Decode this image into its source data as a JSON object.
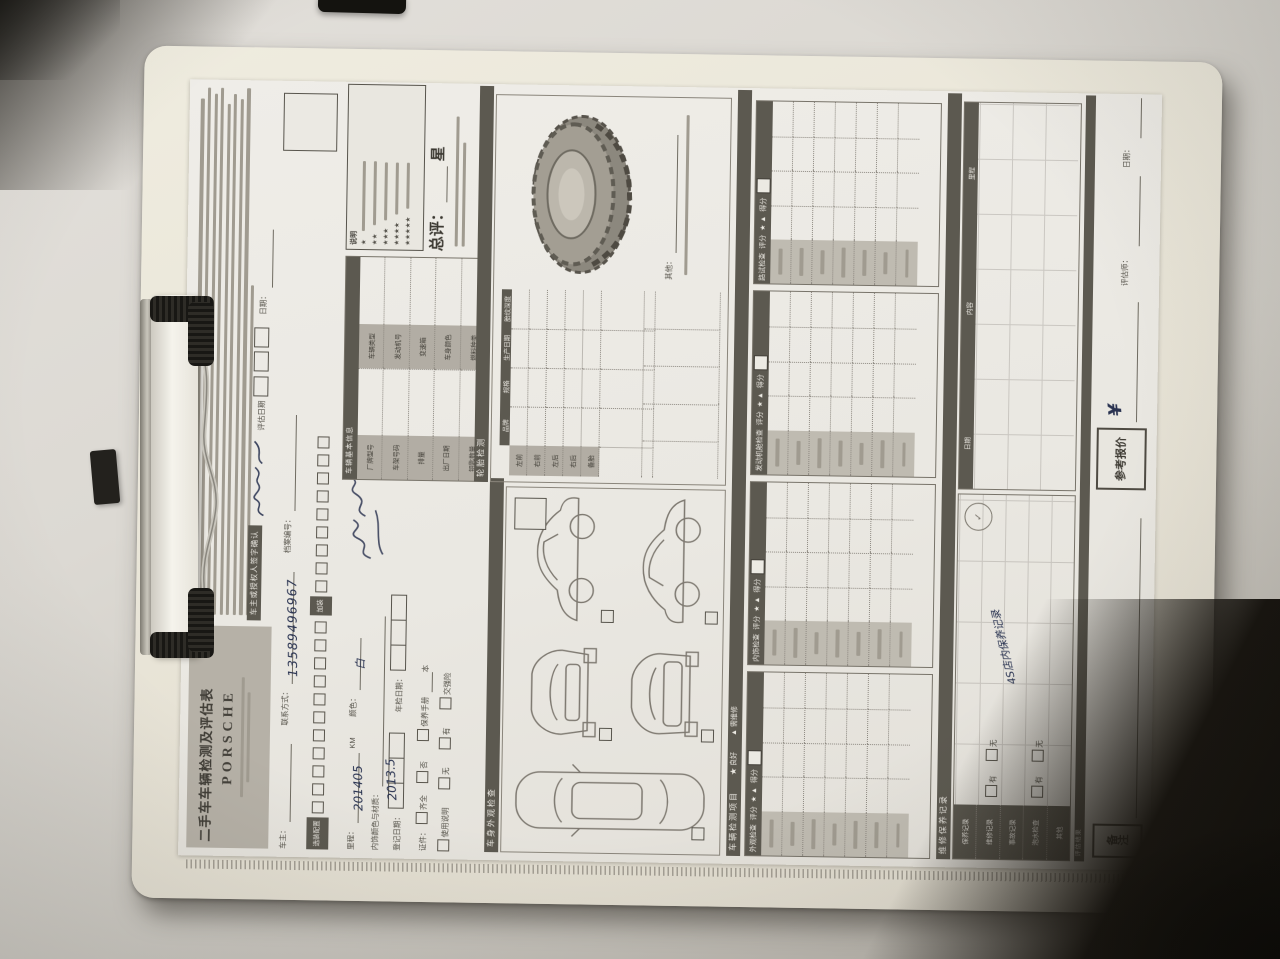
{
  "photo": {
    "desk_color": "#d7d3cd",
    "board_color": "#e9e5da",
    "paper_color": "#ebe9e3",
    "accent_dark_bar": "#5b574e",
    "label_cell_gray": "#b4afa5",
    "handwriting_ink": "#26304f"
  },
  "form": {
    "header": {
      "title": "二手车车辆检测及评估表",
      "brand": "PORSCHE",
      "fine_print_lines": 9,
      "sign_label": "车主或授权人签字确认",
      "eval_date_label": "评估日期",
      "date_label": "日期："
    },
    "owner_row": {
      "owner_label": "车主：",
      "contact_label": "联系方式：",
      "contact_value": "13589496967",
      "file_label": "档案编号："
    },
    "options": {
      "label": "选装配置",
      "label2": "加装",
      "checkbox_count": 20
    },
    "basic": {
      "title": "车辆基本信息",
      "labels": [
        "厂牌型号",
        "车辆类型",
        "车架号码",
        "发动机号",
        "排量",
        "变速箱",
        "出厂日期",
        "车身颜色",
        "钥匙数量",
        "燃料种类"
      ]
    },
    "legend": {
      "title": "说明",
      "stars": [
        "★",
        "★★",
        "★★★",
        "★★★★",
        "★★★★★"
      ]
    },
    "overall": {
      "label": "总评：",
      "unit": "星"
    },
    "reg": {
      "mileage_label": "里程：",
      "mileage_value": "201405",
      "mileage_unit": "KM",
      "color_label": "颜色：",
      "color_value": "白",
      "interior_label": "内饰颜色与材质：",
      "reg_date_label": "登记日期：",
      "reg_date_value": "2013.5",
      "insp_date_label": "年检日期：",
      "docs_label": "证件：",
      "check_full": "齐全",
      "check_no": "否",
      "check_manual": "保养手册",
      "check_book": "使用说明",
      "check_unit": "本",
      "check_none": "无",
      "check_have": "有",
      "check_insurance": "交强险"
    },
    "body_section": {
      "title": "车身外观检查"
    },
    "tire": {
      "title": "轮胎检测",
      "cols": [
        "品牌",
        "规格",
        "生产日期",
        "胎纹深度"
      ],
      "rows": [
        "左前",
        "右前",
        "左后",
        "右后",
        "备胎"
      ],
      "other_label": "其他："
    },
    "inspect": {
      "bar_title": "车辆检测项目",
      "legend_good": "★ 良好",
      "legend_bad": "▲ 需维修",
      "score_label": "得分",
      "rating_label": "评分",
      "rating_marks": "★ ▲",
      "sections": [
        "外观检查",
        "内饰检查",
        "发动机舱检查",
        "路试检查"
      ]
    },
    "records": {
      "title": "维修保养记录",
      "row_labels": [
        "保养记录",
        "维修记录",
        "事故记录",
        "泡水检查",
        "其他"
      ],
      "check_have": "有",
      "check_none": "无",
      "note_handwriting": "4S店内保养记录",
      "grid_cols": [
        "日期",
        "内容",
        "里程"
      ]
    },
    "footer": {
      "bar_title": "评估结果",
      "remark_label": "备注",
      "quote_label": "参考报价",
      "quote_value": "¥",
      "assessor_label": "评估师：",
      "date_label": "日期："
    }
  }
}
